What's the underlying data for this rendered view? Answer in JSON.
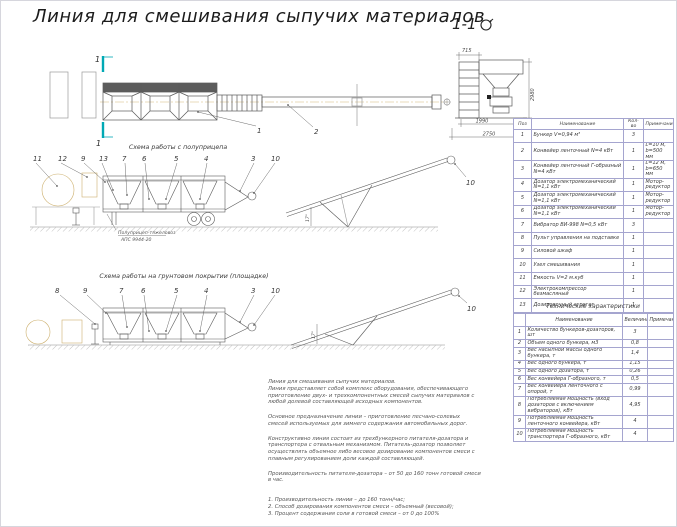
{
  "sheet": {
    "title": "Линия для смешивания сыпучих материалов"
  },
  "colors": {
    "section_mark_teal": "#00a9b5",
    "table_border_purple": "#6b63c8",
    "centerline_tan": "#d2b878",
    "linework_gray": "#5a5a5a"
  },
  "section_view": {
    "label": "1-1",
    "dim_width_cab": "715",
    "dim_height": "2980",
    "dim_width_inner": "1990",
    "dim_width_total": "2750"
  },
  "plan_view": {
    "section_mark": "1",
    "callout_hopper": "1",
    "callout_conveyor": "2"
  },
  "scheme_trailer": {
    "label": "Схема работы с полуприцепа",
    "callouts": [
      "11",
      "12",
      "9",
      "13",
      "7",
      "6",
      "5",
      "4",
      "3",
      "10"
    ],
    "conveyor_callout": "10",
    "incline_angle": "17°",
    "trailer_name": "Полуприцеп-тяжеловоз",
    "trailer_model": "АПС 9944-20"
  },
  "scheme_ground": {
    "label": "Схема работы на грунтовом покрытии (площадке)",
    "callouts": [
      "8",
      "9",
      "7",
      "6",
      "5",
      "4",
      "3",
      "10"
    ],
    "conveyor_callout": "10",
    "incline_angle": "17°"
  },
  "parts_table": {
    "headers": [
      "Поз",
      "Наименование",
      "Кол-во",
      "Примечание"
    ],
    "rows": [
      [
        "1",
        "Бункер V=0,94 м³",
        "3",
        ""
      ],
      [
        "2",
        "Конвейер ленточный N=4 кВт",
        "1",
        "L=10 м, b=500 мм"
      ],
      [
        "3",
        "Конвейер ленточный Г-образный N=4 кВт",
        "1",
        "L=12 м, b=650 мм"
      ],
      [
        "4",
        "Дозатор электромеханический N=1,1 кВт",
        "1",
        "Мотор-редуктор"
      ],
      [
        "5",
        "Дозатор электромеханический N=1,1 кВт",
        "1",
        "Мотор-редуктор"
      ],
      [
        "6",
        "Дозатор электромеханический N=1,1 кВт",
        "1",
        "Мотор-редуктор"
      ],
      [
        "7",
        "Вибратор ВИ-998 N=0,5 кВт",
        "3",
        ""
      ],
      [
        "8",
        "Пульт управления на подставке",
        "1",
        ""
      ],
      [
        "9",
        "Силовой шкаф",
        "1",
        ""
      ],
      [
        "10",
        "Узел смешивания",
        "1",
        ""
      ],
      [
        "11",
        "Емкость V=2 м.куб",
        "1",
        ""
      ],
      [
        "12",
        "Электрокомпрессор безмасляный",
        "1",
        ""
      ],
      [
        "13",
        "Дозировочный агрегат",
        "1",
        ""
      ]
    ]
  },
  "specs_table": {
    "title": "Технические характеристики",
    "headers": [
      "",
      "Наименование",
      "Величина",
      "Примечание"
    ],
    "rows": [
      [
        "1",
        "Количество бункеров-дозаторов, шт",
        "3",
        ""
      ],
      [
        "2",
        "Объем одного бункера, м3",
        "0,8",
        ""
      ],
      [
        "3",
        "Вес насыпной массы одного бункера, т",
        "1,4",
        ""
      ],
      [
        "4",
        "Вес одного бункера, т",
        "1,15",
        ""
      ],
      [
        "5",
        "Вес одного дозатора, т",
        "0,26",
        ""
      ],
      [
        "6",
        "Вес конвейера Г-образного, т",
        "0,5",
        ""
      ],
      [
        "7",
        "Вес конвейера ленточного с опорой, т",
        "0,99",
        ""
      ],
      [
        "8",
        "Потребляемая мощность (вход дозаторов с включением вибраторов), кВт",
        "4,95",
        ""
      ],
      [
        "9",
        "Потребляемая мощность ленточного конвейера, кВт",
        "4",
        ""
      ],
      [
        "10",
        "Потребляемая мощность транспортера Г-образного, кВт",
        "4",
        ""
      ]
    ]
  },
  "notes": {
    "intro_line": "Линия для смешивания сыпучих материалов.",
    "paragraphs": [
      "Линия представляет собой комплекс оборудования, обеспечивающего приготовление двух- и трехкомпонентных смесей сыпучих материалов с любой долевой составляющей исходных компонентов.",
      "Основное предназначение линии – приготовление песчано-солевых смесей используемых для зимнего содержания автомобильных дорог.",
      "Конструктивно линия состоит из трехбункерного питателя-дозатора и транспортера с отвальным механизмом. Питатель-дозатор позволяет осуществлять объемное либо весовое дозирование компонентов смеси с плавным регулированием доли каждой составляющей.",
      "Производительность питателя-дозатора – от 50 до 160 тонн готовой смеси в час."
    ],
    "specs_list": [
      "1. Производительность линии – до 160 тонн/час;",
      "2. Способ дозирования компонентов смеси – объемный (весовой);",
      "3. Процент содержания соли в готовой смеси – от 0 до 100%"
    ]
  }
}
